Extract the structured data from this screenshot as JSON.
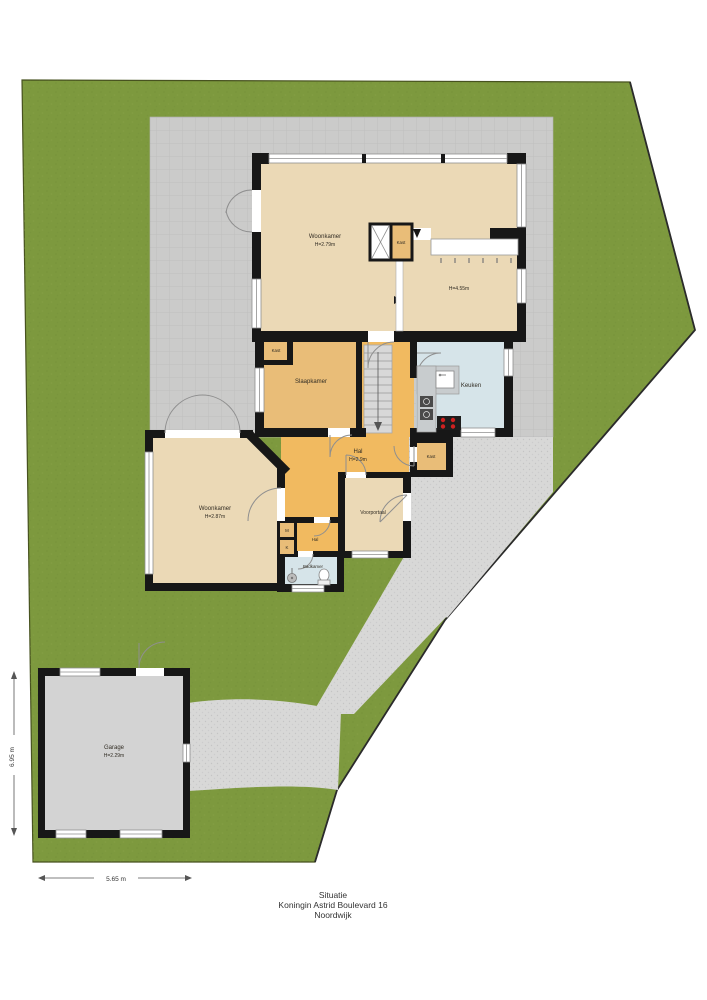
{
  "footer": {
    "line1": "Situatie",
    "line2": "Koningin Astrid Boulevard 16",
    "line3": "Noordwijk"
  },
  "rooms": {
    "woonkamer_boven": {
      "name": "Woonkamer",
      "height": "H=2.79m"
    },
    "eethoek": {
      "height": "H=4.55m"
    },
    "kast_woonkamer": {
      "name": "Kast"
    },
    "kast_slaapkamer": {
      "name": "Kast"
    },
    "slaapkamer": {
      "name": "Slaapkamer"
    },
    "keuken": {
      "name": "Keuken"
    },
    "hal": {
      "name": "Hal",
      "height": "H=2.9m"
    },
    "kast_hal": {
      "name": "Kast"
    },
    "woonkamer_beneden": {
      "name": "Woonkamer",
      "height": "H=2.87m"
    },
    "voorportaal": {
      "name": "Voorportaal"
    },
    "hal_klein": {
      "name": "Hal"
    },
    "meterkast": {
      "label": "M"
    },
    "kast_k": {
      "label": "K"
    },
    "badkamer": {
      "name": "Badkamer"
    },
    "garage": {
      "name": "Garage",
      "height": "H=2.29m"
    }
  },
  "dimensions": {
    "garage_breedte": "5.65 m",
    "garage_diepte": "6.95 m"
  },
  "colors": {
    "garden": "#7d993e",
    "garden_edge": "#47521f",
    "terrace": "#cbcbca",
    "path": "#d8d8d7",
    "wall": "#171717",
    "room_tan": "#ebd9b6",
    "room_orange": "#e9bd78",
    "room_orange_bright": "#f1ba60",
    "room_blue": "#d6e4e9",
    "stairs": "#d8d8d8",
    "garage_floor": "#d3d3d3",
    "counter": "#c8ccce",
    "stove": "#1d1d1d",
    "burner": "#cf2121"
  }
}
